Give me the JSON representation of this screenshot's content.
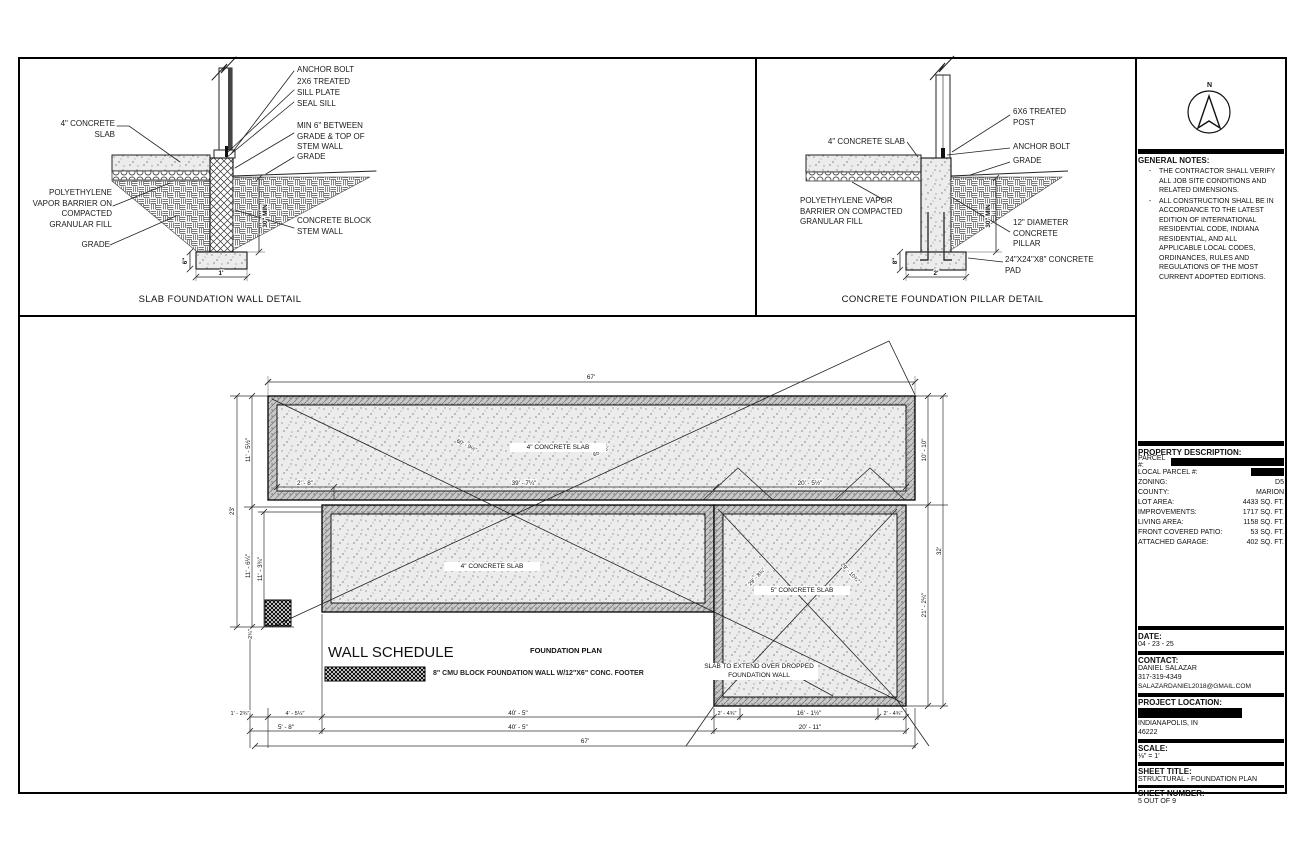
{
  "sheet": {
    "details": {
      "slab_wall": {
        "title": "SLAB FOUNDATION WALL DETAIL",
        "labels": {
          "concrete_slab": "4\" CONCRETE SLAB",
          "vapor_barrier": "POLYETHYLENE VAPOR BARRIER ON COMPACTED GRANULAR FILL",
          "grade_left": "GRADE",
          "anchor_bolt": "ANCHOR BOLT",
          "sill_plate": "2X6 TREATED SILL PLATE",
          "seal_sill": "SEAL SILL",
          "min6": "MIN 6\" BETWEEN GRADE & TOP OF STEM WALL",
          "grade_right": "GRADE",
          "stem_wall": "CONCRETE BLOCK STEM WALL"
        },
        "dims": {
          "stem_depth": "30\" MIN",
          "footing_height": "6\"",
          "footing_width": "1'"
        }
      },
      "pillar": {
        "title": "CONCRETE FOUNDATION PILLAR DETAIL",
        "labels": {
          "concrete_slab": "4\" CONCRETE SLAB",
          "vapor_barrier": "POLYETHYLENE VAPOR BARRIER ON COMPACTED GRANULAR FILL",
          "post": "6X6 TREATED POST",
          "anchor_bolt": "ANCHOR BOLT",
          "grade": "GRADE",
          "pillar": "12\" DIAMETER CONCRETE PILLAR",
          "pad": "24\"X24\"X8\" CONCRETE PAD"
        },
        "dims": {
          "pillar_depth": "30\" MIN",
          "pad_height": "8\"",
          "pad_width": "2'"
        }
      }
    },
    "plan": {
      "caption": "FOUNDATION PLAN",
      "slab_top": "4\" CONCRETE SLAB",
      "slab_mid": "4\" CONCRETE SLAB",
      "slab_right": "5\" CONCRETE SLAB",
      "dropped_note": "SLAB TO EXTEND OVER DROPPED FOUNDATION WALL",
      "wall_schedule": {
        "title": "WALL SCHEDULE",
        "item": "8\" CMU BLOCK FOUNDATION WALL W/12\"X6\" CONC. FOOTER"
      },
      "dims": {
        "top": "67'",
        "bottom": "67'",
        "left_total": "23'",
        "l1": "11' - 5½\"",
        "l2": "11' - 6¼\"",
        "l3": "11' - 3¾\"",
        "l4": "2¾\"",
        "r1": "10' - 10\"",
        "r2": "21' - 2¼\"",
        "right_total": "32'",
        "b1": "1' - 2¾\"",
        "b2": "4' - 5¼\"",
        "b3": "40' - 5\"",
        "b4": "2' - 4¾\"",
        "b5": "16' - 1½\"",
        "b6": "2' - 4¾\"",
        "b7": "5' - 8\"",
        "b8": "40' - 5\"",
        "b9": "20' - 11\"",
        "i1": "2' - 8\"",
        "i2": "39' - 7¼\"",
        "i3": "20' - 5½\"",
        "d1": "60' - 9½\"",
        "d2": "65' - 6\"",
        "d3": "29' - 8¾\"",
        "d4": "29' - 10¾\""
      }
    },
    "sidebar": {
      "north": "N",
      "general_notes": {
        "title": "GENERAL NOTES:",
        "bullet": "-",
        "items": [
          "THE CONTRACTOR SHALL VERIFY ALL JOB SITE CONDITIONS AND RELATED DIMENSIONS.",
          "ALL CONSTRUCTION SHALL BE IN ACCORDANCE TO THE LATEST EDITION OF INTERNATIONAL RESIDENTIAL CODE, INDIANA RESIDENTIAL, AND ALL APPLICABLE LOCAL CODES, ORDINANCES, RULES AND REGULATIONS OF THE MOST CURRENT ADOPTED EDITIONS."
        ]
      },
      "property": {
        "title": "PROPERTY DESCRIPTION:",
        "rows": [
          {
            "label": "PARCEL #:",
            "value": ""
          },
          {
            "label": "LOCAL PARCEL #:",
            "value": ""
          },
          {
            "label": "ZONING:",
            "value": "D5"
          },
          {
            "label": "COUNTY:",
            "value": "MARION"
          },
          {
            "label": "LOT AREA:",
            "value": "4433 SQ. FT."
          },
          {
            "label": "IMPROVEMENTS:",
            "value": "1717 SQ. FT."
          },
          {
            "label": "LIVING AREA:",
            "value": "1158 SQ. FT."
          },
          {
            "label": "FRONT COVERED PATIO:",
            "value": "53 SQ. FT."
          },
          {
            "label": "ATTACHED GARAGE:",
            "value": "402 SQ. FT."
          }
        ]
      },
      "date": {
        "title": "DATE:",
        "value": "04 - 23 - 25"
      },
      "contact": {
        "title": "CONTACT:",
        "name": "DANIEL SALAZAR",
        "phone": "317-319-4349",
        "email": "SALAZARDANIEL2018@GMAIL.COM"
      },
      "location": {
        "title": "PROJECT LOCATION:",
        "city": "INDIANAPOLIS, IN",
        "zip": "46222"
      },
      "scale": {
        "title": "SCALE:",
        "value": "⅛\" = 1'"
      },
      "sheet_title": {
        "title": "SHEET TITLE:",
        "value": "STRUCTURAL - FOUNDATION PLAN"
      },
      "sheet_number": {
        "title": "SHEET NUMBER:",
        "value": "5 OUT OF 9"
      }
    }
  }
}
